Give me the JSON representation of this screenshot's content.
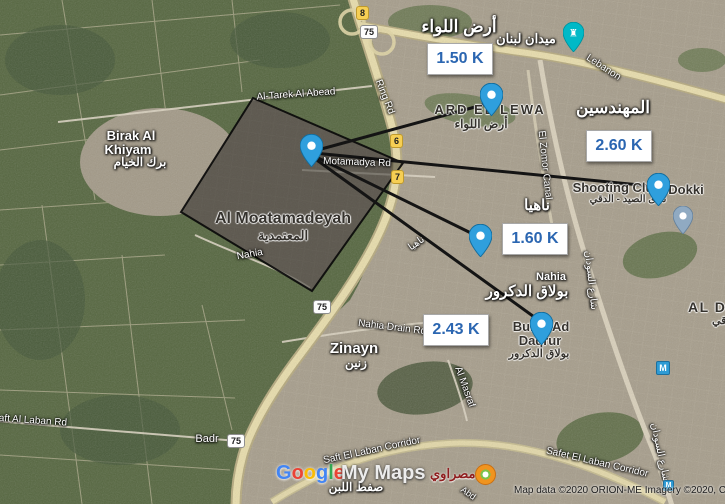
{
  "distances": {
    "ard_el_lewa": "1.50 K",
    "mohandessin": "2.60 K",
    "nahia": "1.60 K",
    "bulaq_ad_daqrur": "2.43 K"
  },
  "places": {
    "ard_el_lewa_ar_big": "أرض اللواء",
    "mohandessin_ar": "المهندسين",
    "nahia_ar_big": "ناهيا",
    "bulaq_ar_big": "بولاق الدكرور",
    "birak_line1": "Birak Al",
    "birak_line2": "Khiyam",
    "birak_ar": "برك الخيام",
    "zinayn": "Zinayn",
    "zinayn_ar": "زنين",
    "nahia_small": "Nahia",
    "ard_el_lewa_caps": "ARD EL LEWA",
    "ard_el_lewa_ar_small": "أرض اللواء",
    "moatamadeyah": "Al Moatamadeyah",
    "moatamadeyah_ar": "المعتمدية",
    "shooting_club": "Shooting Club",
    "dokki": "Dokki",
    "shooting_club_ar": "نادى الصيد - الدقي",
    "bulaq_line1": "Bulaq Ad",
    "bulaq_line2": "Daqrur",
    "bulaq_ar_small": "بولاق الدكرور",
    "al_doqi_caps": "AL DOQI",
    "al_doqi_ar": "الدقي",
    "lebanon_square_ar": "ميدان لبنان"
  },
  "roads": {
    "tarek": "Al-Tarek Al Abead",
    "ring_rd": "Ring Rd",
    "motamadya": "Motamadya Rd",
    "lebanon": "Lebanon",
    "zomor_canal": "El Zomor Canal",
    "sudan_st_ar": "شارع السودان",
    "nahia_road": "Nahia",
    "nahia_ar_small": "ناهيا",
    "nahia_drain": "Nahia Drain Rd",
    "al_masraf": "Al Masraf",
    "saft_al_laban_rd": "Saft Al Laban Rd",
    "badr": "Badr",
    "saft_corridor": "Saft El Laban Corridor",
    "safet_corridor": "Safet El Laban Corridor",
    "saft_ar": "صفط اللبن",
    "abd": "Abd"
  },
  "badges": {
    "route8": "8",
    "route75": "75",
    "route6": "6",
    "route7": "7"
  },
  "branding": {
    "google_letters": {
      "l1": "G",
      "l2": "o",
      "l3": "o",
      "l4": "g",
      "l5": "l",
      "l6": "e"
    },
    "my_maps": "My Maps",
    "masrawy_ar": "مصراوي",
    "attribution": "Map data ©2020 ORION-ME Imagery ©2020, C",
    "metro_m": "M"
  },
  "icons": {
    "landmark_glyph": "♜"
  },
  "colors": {
    "marker_blue": "#2f9fdd",
    "marker_gray": "#90aac2",
    "poi_teal": "#00b9c7",
    "distance_text": "#2b66b1",
    "overlay_line": "#141414"
  }
}
